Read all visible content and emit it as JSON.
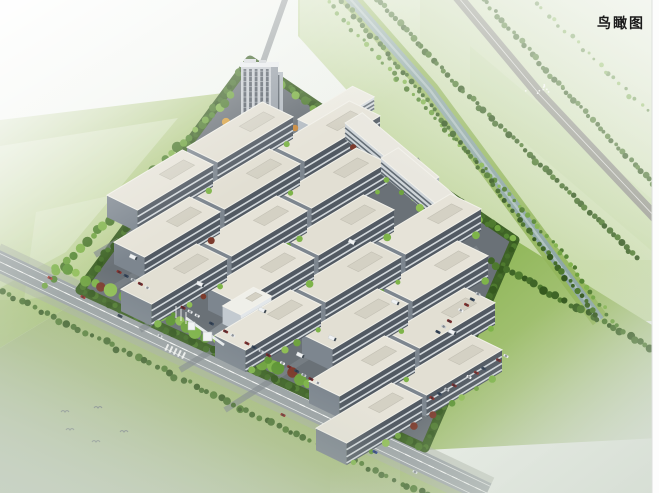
{
  "page": {
    "label": "鸟瞰图"
  },
  "palette": {
    "mist_a": "#f3f6f1",
    "mist_b": "#e7ece5",
    "field_pale": "#dfe7d2",
    "field_mid": "#b3cb85",
    "field_green": "#8fb354",
    "field_bright": "#84b148",
    "field_fade": "#d2dbcc",
    "corridor_a": "#b5cf86",
    "corridor_b": "#e4ebd9",
    "asphalt": "#6a7177",
    "lane": "#7d848b",
    "road": "#9aa1a4",
    "driveway": "#868d93",
    "canal": "#8ea6a9",
    "canal_streak": "#c6d4d4",
    "bank": "#93b65c",
    "hedge_base": "#3e6126",
    "roof": "#e6e3d8",
    "roof_edge": "#f2f1ea",
    "wall_front": "#525a63",
    "wall_end": "#7d868f",
    "window_stripe": "#dfe5e9",
    "white_wall": "#e3e7ea",
    "white_end": "#c3cad0",
    "white_roof": "#efefe9",
    "white_stripe": "#97a1a9",
    "tower_frame": "#c7ccd1",
    "tower_glass": "#4a535c",
    "tower_side": "#98a0a8",
    "tower_annex": "#b3bac1",
    "truck": "#eff1f2",
    "shadow": "#3c4a3c",
    "bird": "#6a7278",
    "label_color": "#1b1b1b",
    "orange_tree_1": "#d8a03f",
    "orange_tree_2": "#c9883a",
    "orange_tree_3": "#e0b050",
    "red_shrub": "#7c3b2d"
  },
  "scene": {
    "site_outline": [
      [
        250,
        60
      ],
      [
        515,
        240
      ],
      [
        425,
        448
      ],
      [
        80,
        290
      ]
    ],
    "workshops": [
      [
        160,
        180
      ],
      [
        240,
        132
      ],
      [
        167,
        227
      ],
      [
        247,
        179
      ],
      [
        327,
        131
      ],
      [
        174,
        274
      ],
      [
        254,
        226
      ],
      [
        334,
        178
      ],
      [
        261,
        273
      ],
      [
        341,
        225
      ],
      [
        268,
        320
      ],
      [
        348,
        272
      ],
      [
        428,
        224
      ],
      [
        355,
        319
      ],
      [
        435,
        271
      ],
      [
        442,
        318
      ],
      [
        362,
        366
      ],
      [
        449,
        365
      ],
      [
        369,
        413
      ]
    ],
    "workshop_size": {
      "length": 88,
      "width": 34,
      "wall_height": 22
    },
    "slabs": [
      [
        392,
        150
      ],
      [
        428,
        185
      ]
    ],
    "l_office": [
      336,
      108
    ],
    "white_office": [
      247,
      301
    ],
    "tower": {
      "x": 241,
      "y": 63,
      "w": 30,
      "h": 65
    },
    "orange_trees": [
      [
        286,
        120
      ],
      [
        295,
        128
      ],
      [
        302,
        136
      ],
      [
        226,
        122
      ],
      [
        281,
        141
      ],
      [
        291,
        146
      ]
    ],
    "field_left": [
      [
        0,
        120
      ],
      [
        232,
        92
      ],
      [
        92,
        292
      ],
      [
        0,
        348
      ]
    ],
    "field_bottom": [
      [
        0,
        348
      ],
      [
        92,
        292
      ],
      [
        300,
        392
      ],
      [
        470,
        478
      ],
      [
        487,
        493
      ],
      [
        0,
        493
      ]
    ],
    "field_right": [
      [
        515,
        240
      ],
      [
        660,
        330
      ],
      [
        660,
        438
      ],
      [
        425,
        450
      ]
    ],
    "field_steps": [
      [
        [
          0,
          146
        ],
        [
          178,
          118
        ],
        [
          66,
          252
        ],
        [
          0,
          288
        ]
      ],
      [
        [
          36,
          212
        ],
        [
          226,
          170
        ],
        [
          152,
          278
        ],
        [
          24,
          300
        ]
      ],
      [
        [
          470,
          46
        ],
        [
          660,
          206
        ],
        [
          660,
          258
        ],
        [
          470,
          96
        ]
      ]
    ],
    "corridor_poly": [
      [
        298,
        -20
      ],
      [
        760,
        -20
      ],
      [
        760,
        320
      ],
      [
        556,
        322
      ],
      [
        298,
        36
      ]
    ],
    "canal_path": [
      [
        338,
        -15
      ],
      [
        430,
        90
      ],
      [
        600,
        320
      ]
    ],
    "highway_path": [
      [
        448,
        -15
      ],
      [
        540,
        95
      ],
      [
        672,
        235
      ]
    ],
    "road_main": [
      [
        -6,
        259
      ],
      [
        487,
        493
      ]
    ],
    "driveway": [
      [
        208,
        338
      ],
      [
        252,
        307
      ]
    ],
    "top_stub": [
      [
        263,
        62
      ],
      [
        287,
        -6
      ]
    ],
    "lanes": [
      [
        [
          95,
          255
        ],
        [
          330,
          113
        ]
      ],
      [
        [
          110,
          290
        ],
        [
          380,
          128
        ]
      ],
      [
        [
          140,
          330
        ],
        [
          420,
          160
        ]
      ],
      [
        [
          180,
          370
        ],
        [
          450,
          205
        ]
      ],
      [
        [
          225,
          410
        ],
        [
          478,
          248
        ]
      ]
    ],
    "tree_rows": [
      {
        "pts": [
          [
            46,
            284
          ],
          [
            230,
            96
          ]
        ],
        "step": 8,
        "r": 4.2,
        "pal": "mixed"
      },
      {
        "pts": [
          [
            56,
            266
          ],
          [
            150,
            310
          ],
          [
            336,
            396
          ]
        ],
        "step": 10,
        "r": 5.2,
        "pal": "verge"
      },
      {
        "pts": [
          [
            2,
            292
          ],
          [
            240,
            408
          ],
          [
            472,
            516
          ]
        ],
        "step": 7,
        "r": 3.0,
        "pal": "dark"
      },
      {
        "pts": [
          [
            252,
            66
          ],
          [
            512,
            240
          ]
        ],
        "step": 9,
        "r": 3.6,
        "pal": "mixed"
      },
      {
        "pts": [
          [
            492,
            262
          ],
          [
            656,
            350
          ]
        ],
        "step": 6,
        "r": 3.4,
        "pal": "dark"
      },
      {
        "pts": [
          [
            318,
            -8
          ],
          [
            398,
            78
          ],
          [
            562,
            252
          ],
          [
            616,
            326
          ]
        ],
        "step": 7,
        "r": 2.2,
        "pal": "mixed"
      },
      {
        "pts": [
          [
            331,
            -12
          ],
          [
            419,
            90
          ],
          [
            596,
            316
          ]
        ],
        "step": 6,
        "r": 2.6,
        "pal": "dark"
      },
      {
        "pts": [
          [
            366,
            -14
          ],
          [
            456,
            84
          ],
          [
            638,
            258
          ]
        ],
        "step": 5.5,
        "r": 2.8,
        "pal": "dark"
      },
      {
        "pts": [
          [
            472,
            -14
          ],
          [
            562,
            88
          ],
          [
            680,
            212
          ]
        ],
        "step": 5.5,
        "r": 2.6,
        "pal": "dark"
      },
      {
        "pts": [
          [
            520,
            -14
          ],
          [
            606,
            72
          ],
          [
            690,
            152
          ]
        ],
        "step": 8,
        "r": 2.0,
        "pal": "mixed"
      }
    ],
    "parking_rows": [
      {
        "a": [
          112,
          268
        ],
        "b": [
          318,
          383
        ],
        "step": 8
      },
      {
        "a": [
          432,
          398
        ],
        "b": [
          506,
          356
        ],
        "step": 8
      },
      {
        "a": [
          438,
          332
        ],
        "b": [
          478,
          294
        ],
        "step": 7
      }
    ],
    "car_colors": [
      "#f2f4f5",
      "#8b3530",
      "#3a4a5e",
      "#c9ced2",
      "#7a2e2e",
      "#e8eaec"
    ],
    "road_cars": [
      [
        50,
        278,
        "#b23b32"
      ],
      [
        83,
        297,
        "#9c2f2a"
      ],
      [
        120,
        316,
        "#2f3c4c"
      ],
      [
        283,
        415,
        "#8e2c26"
      ],
      [
        375,
        452,
        "#27408f"
      ],
      [
        415,
        472,
        "#d8dde0"
      ],
      [
        160,
        336,
        "#d0d4d8"
      ]
    ],
    "trucks": [
      [
        133,
        257
      ],
      [
        200,
        284
      ],
      [
        262,
        310
      ],
      [
        332,
        338
      ],
      [
        395,
        302
      ],
      [
        352,
        242
      ],
      [
        300,
        355
      ],
      [
        452,
        332
      ]
    ],
    "gate": {
      "pos": [
        196,
        331
      ],
      "canopy_a": [
        186,
        318
      ],
      "canopy_b": [
        224,
        345
      ]
    },
    "flagpoles": [
      [
        176,
        318
      ],
      [
        181,
        321
      ],
      [
        186,
        324
      ]
    ],
    "birds": [
      [
        65,
        412
      ],
      [
        98,
        408
      ],
      [
        70,
        430
      ],
      [
        96,
        442
      ],
      [
        124,
        432
      ]
    ],
    "speck_cluster": [
      536,
      90
    ]
  }
}
